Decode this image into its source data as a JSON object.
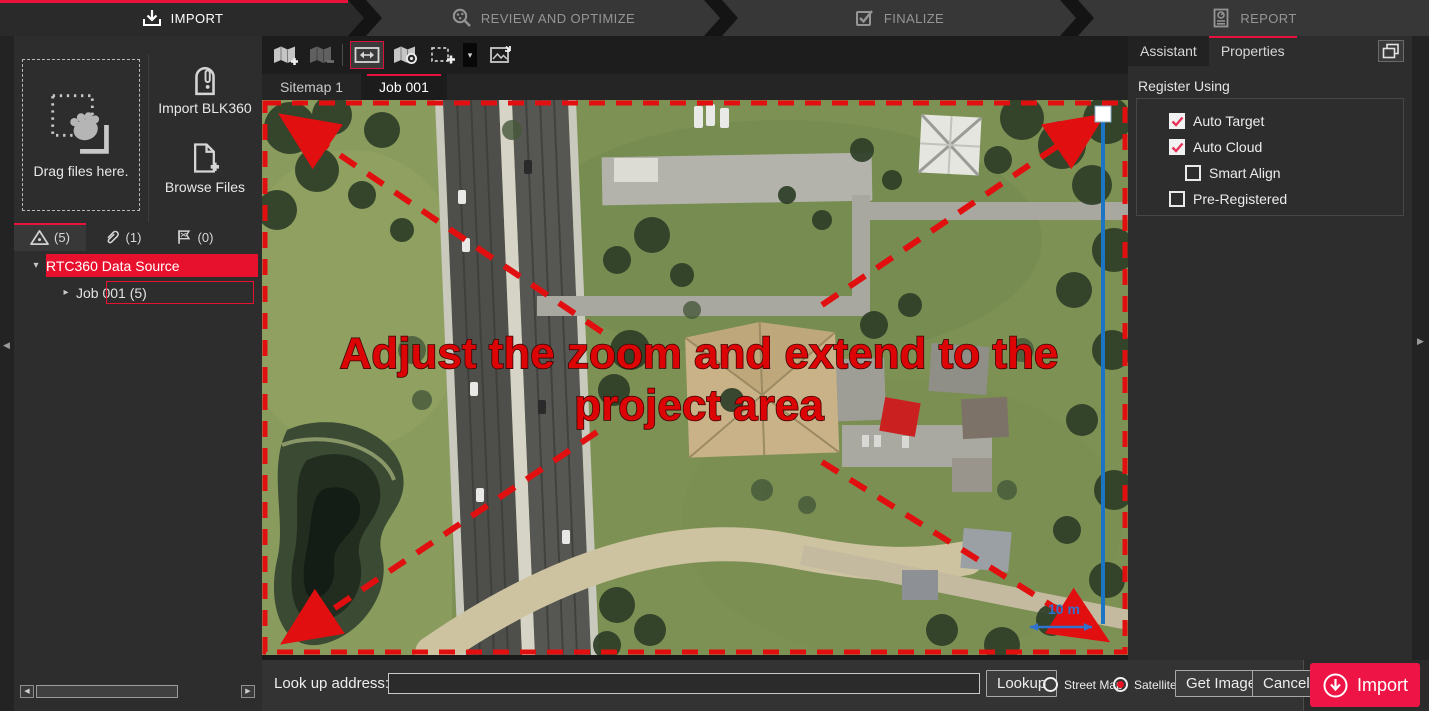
{
  "colors": {
    "accent_red": "#e8123d",
    "selection_red": "#e8112d",
    "overlay_red": "#d90606",
    "map_scale_blue": "#2f73cf",
    "import_button_red": "#ef1446"
  },
  "workflow": {
    "steps": [
      {
        "label": "IMPORT",
        "icon": "import-download-icon",
        "active": true
      },
      {
        "label": "REVIEW AND OPTIMIZE",
        "icon": "magnifier-targets-icon",
        "active": false
      },
      {
        "label": "FINALIZE",
        "icon": "checkbox-check-icon",
        "active": false
      },
      {
        "label": "REPORT",
        "icon": "report-document-icon",
        "active": false
      }
    ]
  },
  "left_panel": {
    "dropzone_label": "Drag files here.",
    "import_blk360_label": "Import BLK360",
    "browse_files_label": "Browse Files",
    "tabs": [
      {
        "icon": "warning-triangle-icon",
        "count": "(5)",
        "active": true
      },
      {
        "icon": "paperclip-icon",
        "count": "(1)",
        "active": false
      },
      {
        "icon": "links-flag-icon",
        "count": "(0)",
        "active": false
      }
    ],
    "tree": {
      "root_label": "RTC360 Data Source",
      "child_label": "Job 001 (5)"
    }
  },
  "center": {
    "sitemap_tabs": [
      {
        "label": "Sitemap 1",
        "active": false
      },
      {
        "label": "Job 001",
        "active": true
      }
    ],
    "map": {
      "overlay_line1": "Adjust the zoom and extend to the",
      "overlay_line2": "project area",
      "scale_label": "10 m"
    }
  },
  "right_panel": {
    "tabs": [
      {
        "label": "Assistant",
        "active": false
      },
      {
        "label": "Properties",
        "active": true
      }
    ],
    "section_title": "Register Using",
    "checkboxes": [
      {
        "label": "Auto Target",
        "checked": true
      },
      {
        "label": "Auto Cloud",
        "checked": true
      },
      {
        "label": "Smart Align",
        "checked": false
      },
      {
        "label": "Pre-Registered",
        "checked": false
      }
    ]
  },
  "bottom_bar": {
    "address_label": "Look up address:",
    "address_value": "",
    "lookup_label": "Lookup",
    "street_map_label": "Street Map",
    "satellite_label": "Satellite",
    "satellite_selected": true,
    "get_image_label": "Get Image",
    "cancel_label": "Cancel",
    "import_label": "Import"
  },
  "icons": {
    "caret_down": "▾",
    "caret_right": "▸",
    "scroll_left": "◀",
    "scroll_right": "▶",
    "collapse_left": "◀",
    "expand_right": "▶",
    "dropdown_caret": "▾"
  }
}
